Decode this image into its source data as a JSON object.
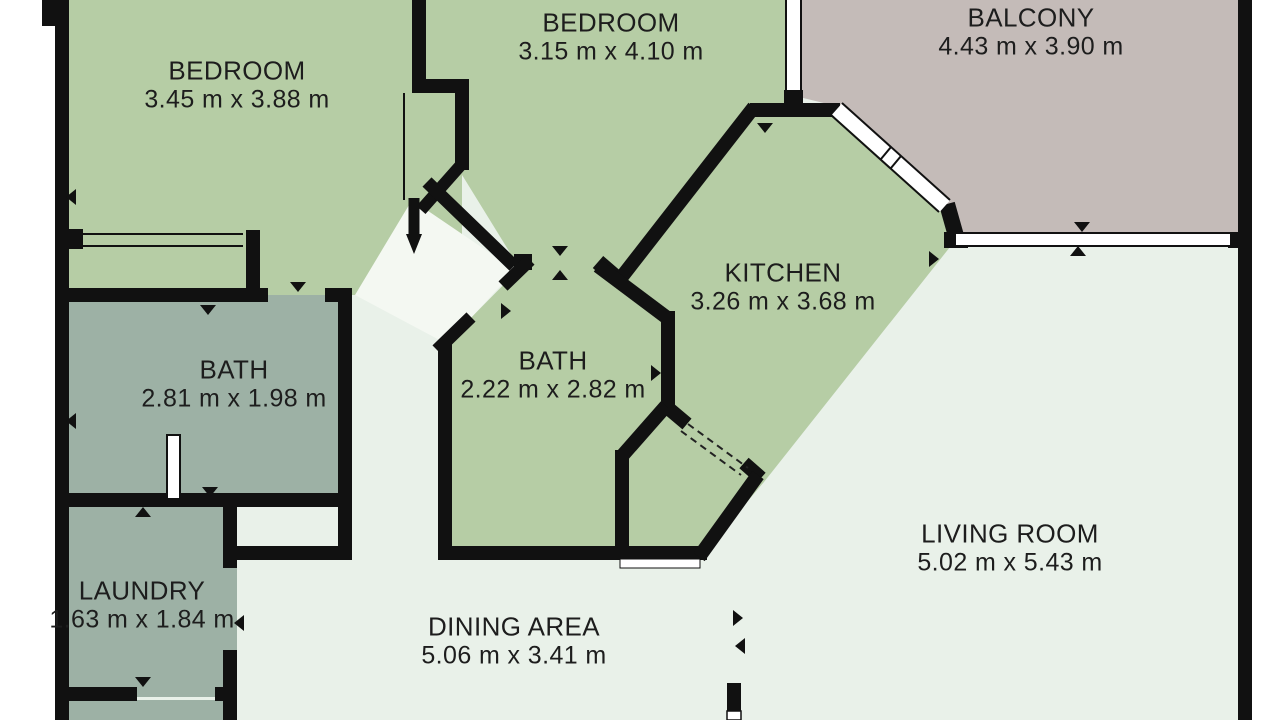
{
  "plan": {
    "title": "Apartment floor plan",
    "units": "m",
    "rooms": [
      {
        "id": "bedroom-1",
        "name": "BEDROOM",
        "dimensions": "3.45 m x 3.88 m"
      },
      {
        "id": "bedroom-2",
        "name": "BEDROOM",
        "dimensions": "3.15 m x 4.10 m"
      },
      {
        "id": "balcony",
        "name": "BALCONY",
        "dimensions": "4.43 m x 3.90 m"
      },
      {
        "id": "kitchen",
        "name": "KITCHEN",
        "dimensions": "3.26 m x 3.68 m"
      },
      {
        "id": "bath-main",
        "name": "BATH",
        "dimensions": "2.81 m x 1.98 m"
      },
      {
        "id": "bath-second",
        "name": "BATH",
        "dimensions": "2.22 m x 2.82 m"
      },
      {
        "id": "laundry",
        "name": "LAUNDRY",
        "dimensions": "1.63 m x 1.84 m"
      },
      {
        "id": "living-room",
        "name": "LIVING ROOM",
        "dimensions": "5.02 m x 5.43 m"
      },
      {
        "id": "dining-area",
        "name": "DINING AREA",
        "dimensions": "5.06 m x 3.41 m"
      }
    ],
    "colors": {
      "wall": "#111111",
      "room_green": "#b6cda5",
      "room_gray_green": "#9db1a5",
      "balcony_gray": "#c4bbb8",
      "open_area_pale": "#e9f1e9",
      "corridor_white": "#f4f8f2",
      "background": "#ffffff",
      "text": "#1d1d1d"
    }
  }
}
